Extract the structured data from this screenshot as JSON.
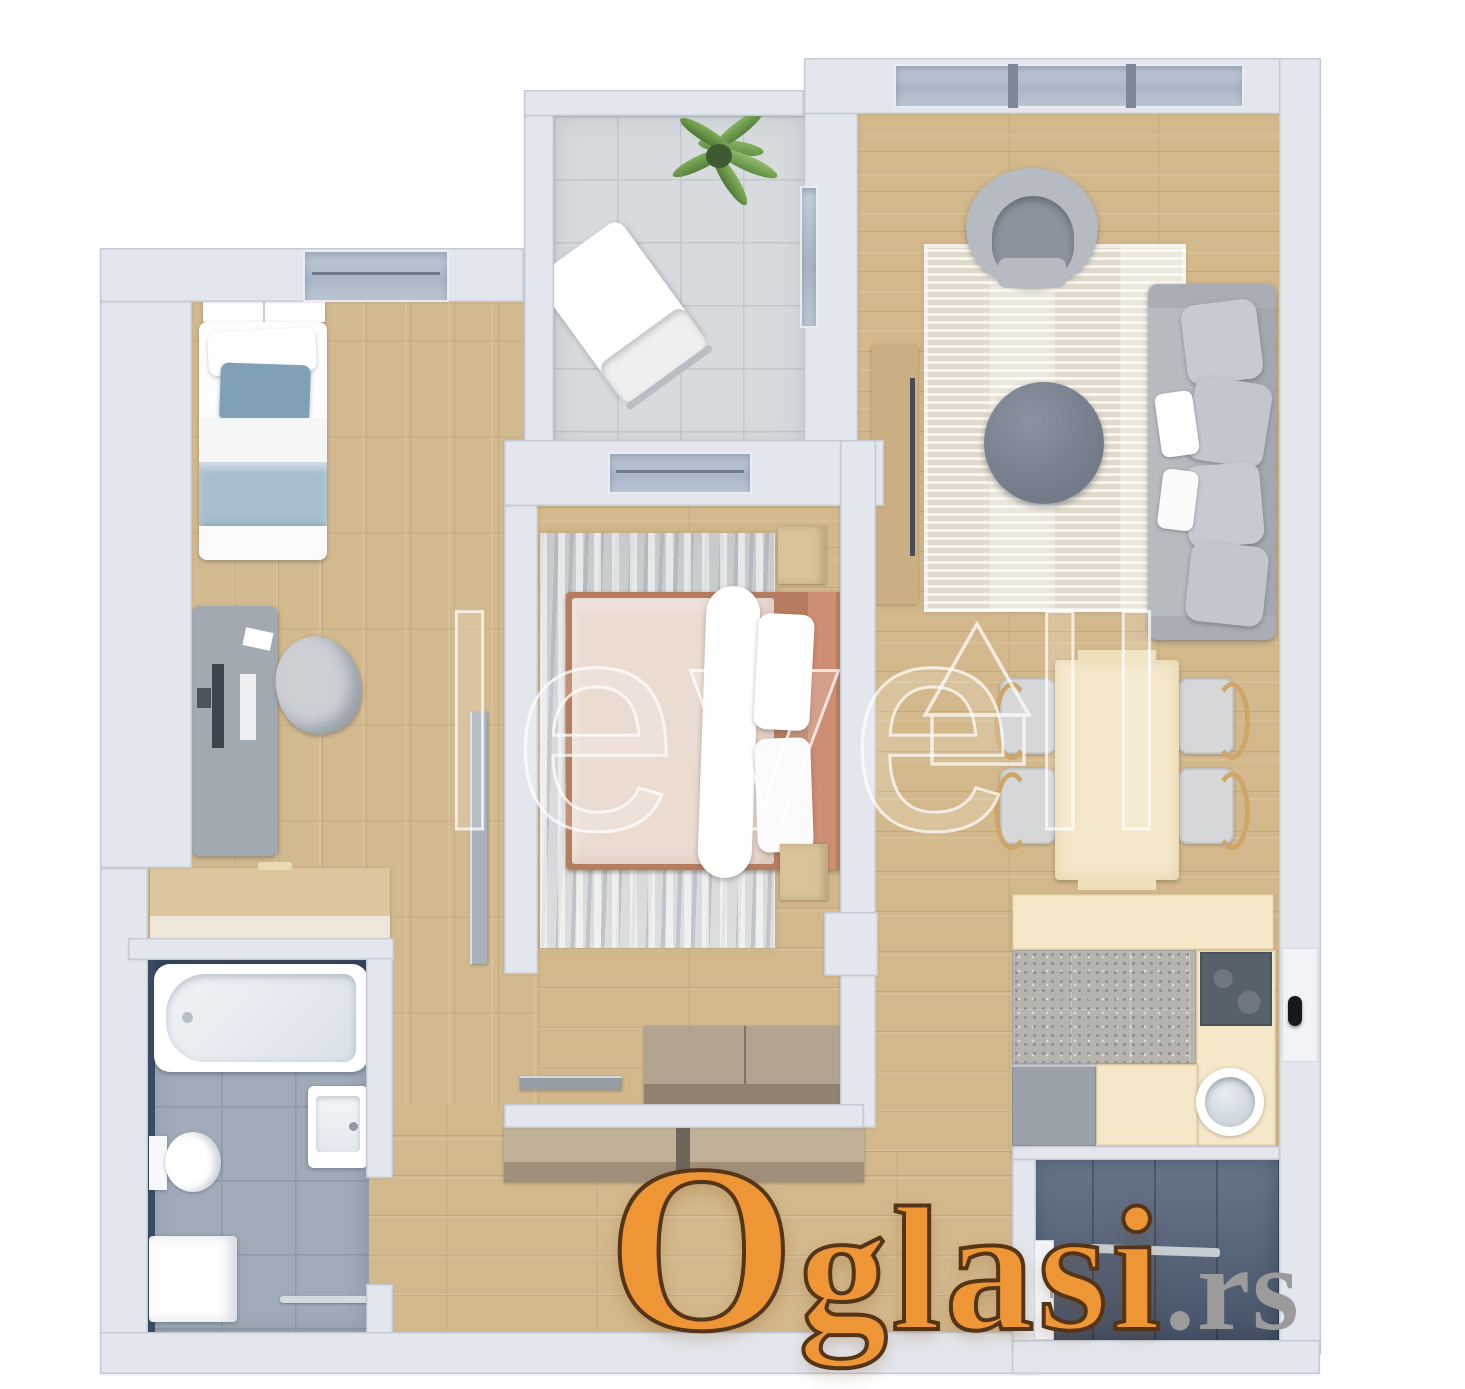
{
  "watermarks": {
    "brand_text": "levell",
    "brand_logo_icon": "triangle-house-outline",
    "portal_name": "Oglasi",
    "portal_tld": ".rs"
  },
  "palette": {
    "background": "#ffffff",
    "wall": "#e3e7ed",
    "wood_floor": "#d3b98e",
    "balcony_tile_light": "#d8dbde",
    "balcony_tile_dark": "#57667f",
    "bathroom_tile": "#9fabb7",
    "bathroom_accent_navy": "#32435a",
    "window_glass": "#a9b5c6",
    "sofa_gray": "#b7babf",
    "bed_blue_pillow": "#7fa0b6",
    "bed_blue_blanket": "#a6becd",
    "master_bed_frame": "#b67c5f",
    "master_duvet": "#ebdcd2",
    "kitchen_counter_cream": "#f5e8c9",
    "dining_wood": "#f4e7c8",
    "logo_orange": "#ee9636",
    "logo_gray": "#9b9b9b"
  }
}
